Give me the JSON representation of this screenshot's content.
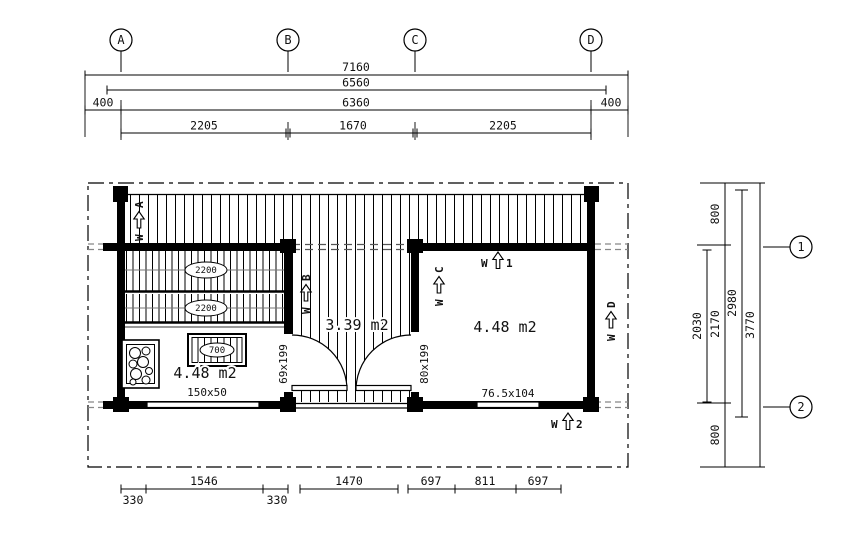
{
  "drawing_type": "sauna cabin floor plan",
  "grid": {
    "columns": [
      "A",
      "B",
      "C",
      "D"
    ],
    "rows": [
      "1",
      "2"
    ]
  },
  "dims": {
    "top": {
      "overall": "7160",
      "second": "6560",
      "left_offset": "400",
      "inner": "6360",
      "right_offset": "400",
      "spans": [
        "2205",
        "1670",
        "2205"
      ]
    },
    "right": {
      "top_offset": "800",
      "inner": "2030",
      "grid_span": "2170",
      "wall_span": "2980",
      "overall": "3770",
      "bottom_offset": "800"
    },
    "bottom": [
      "330",
      "1546",
      "330",
      "1470",
      "697",
      "811",
      "697"
    ]
  },
  "rooms": {
    "sauna": {
      "area": "4.48 m2",
      "window": "150x50",
      "door": "69x199",
      "bench_top": "2200",
      "bench_mid": "2200",
      "bench_small": "700"
    },
    "terrace": {
      "area": "3.39 m2"
    },
    "cabin": {
      "area": "4.48 m2",
      "window": "76.5x104",
      "door": "80x199"
    }
  },
  "walls": {
    "prefix": "W",
    "a": "A",
    "b": "B",
    "c": "C",
    "d": "D",
    "n1": "1",
    "n2": "2"
  },
  "colors": {
    "ink": "#000000",
    "projection_gray": "#888888",
    "rail_gray": "#999999",
    "paper": "#ffffff"
  }
}
